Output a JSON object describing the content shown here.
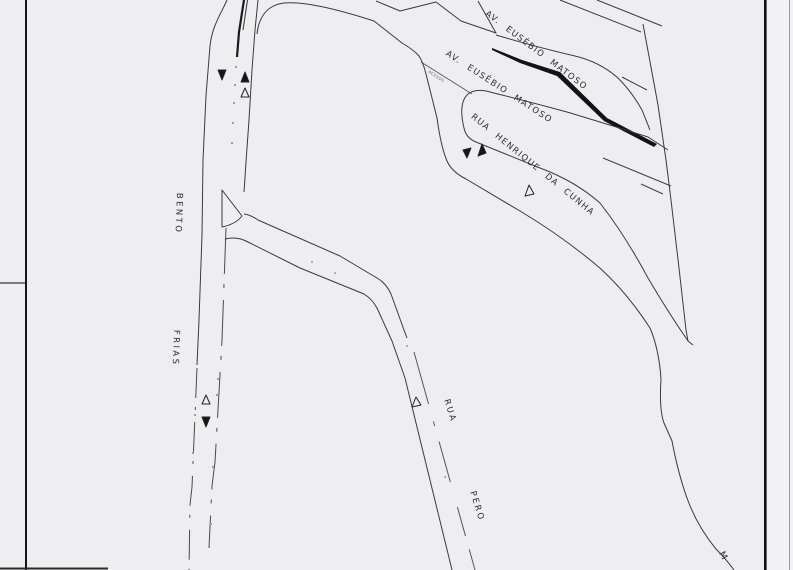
{
  "map": {
    "title": "street plan sketch",
    "street_labels": {
      "av_eusebio_matoso_upper": "AV. EUSÉBIO MATOSO",
      "av_eusebio_matoso_lower": "AV. EUSÉBIO MATOSO",
      "rua_henrique_da_cunha": "RUA HENRIQUE DA CUNHA",
      "bento": "BENTO",
      "frias": "FRIAS",
      "rua": "RUA",
      "pero": "PERO",
      "access_ramp": "ACESSO",
      "marginal_partial": "M"
    },
    "colors": {
      "background": "#eeeef0",
      "line": "#3a3a3a",
      "median": "#141414",
      "border": "#111111"
    }
  }
}
